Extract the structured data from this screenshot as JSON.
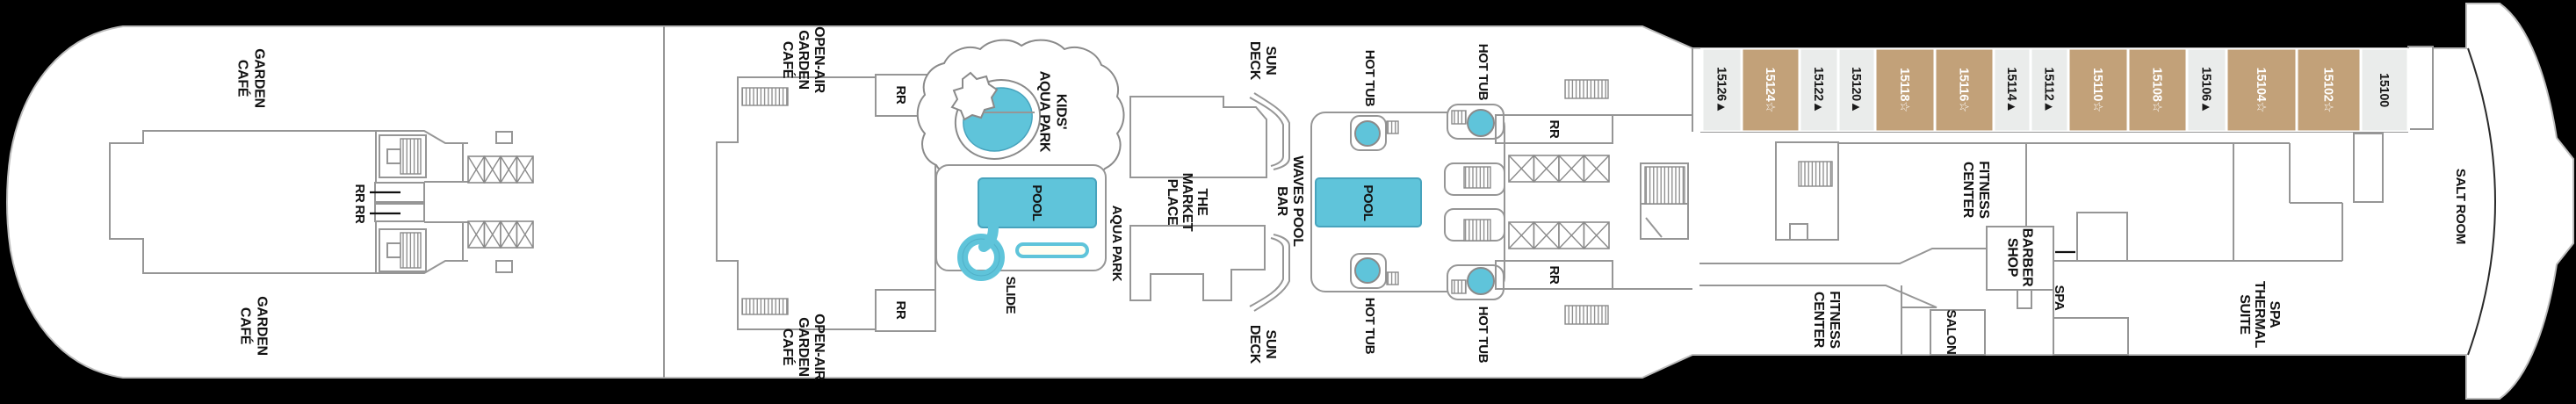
{
  "plan_title": "Cruise ship deck plan - pool and spa deck",
  "colors": {
    "background": "#000000",
    "hull": "#ffffff",
    "wall_line": "#969696",
    "pool_blue": "#5fc4da",
    "pool_blue_stroke": "#47a3bd",
    "cabin_tan": "#c2a179",
    "cabin_light": "#eaeceb",
    "cabin_text_on_tan": "#ffffff",
    "cabin_text_on_light": "#1a1a1a",
    "label_text": "#121212"
  },
  "labels": {
    "garden_cafe_top": {
      "lines": [
        "GARDEN",
        "CAFÉ"
      ]
    },
    "garden_cafe_bottom": {
      "lines": [
        "GARDEN",
        "CAFÉ"
      ]
    },
    "rr_fwd_a": {
      "lines": [
        "RR"
      ]
    },
    "rr_fwd_b": {
      "lines": [
        "RR"
      ]
    },
    "open_air_top": {
      "lines": [
        "OPEN-AIR",
        "GARDEN",
        "CAFÉ"
      ]
    },
    "open_air_bottom": {
      "lines": [
        "OPEN-AIR",
        "GARDEN",
        "CAFÉ"
      ]
    },
    "rr_openair_top": {
      "lines": [
        "RR"
      ]
    },
    "rr_openair_bottom": {
      "lines": [
        "RR"
      ]
    },
    "kids_aqua_park": {
      "lines": [
        "KIDS'",
        "AQUA PARK"
      ]
    },
    "pool_aqua": {
      "lines": [
        "POOL"
      ]
    },
    "slide": {
      "lines": [
        "SLIDE"
      ]
    },
    "aqua_park": {
      "lines": [
        "AQUA PARK"
      ]
    },
    "market_place": {
      "lines": [
        "THE",
        "MARKET",
        "PLACE"
      ]
    },
    "sun_deck_top": {
      "lines": [
        "SUN",
        "DECK"
      ]
    },
    "sun_deck_bottom": {
      "lines": [
        "SUN",
        "DECK"
      ]
    },
    "waves_pool_bar": {
      "lines": [
        "WAVES POOL",
        "BAR"
      ]
    },
    "pool_main": {
      "lines": [
        "POOL"
      ]
    },
    "hot_tub_top_center": {
      "lines": [
        "HOT TUB"
      ]
    },
    "hot_tub_top_right": {
      "lines": [
        "HOT TUB"
      ]
    },
    "hot_tub_bottom_center": {
      "lines": [
        "HOT TUB"
      ]
    },
    "hot_tub_bottom_right": {
      "lines": [
        "HOT TUB"
      ]
    },
    "rr_mid_top": {
      "lines": [
        "RR"
      ]
    },
    "rr_mid_bottom": {
      "lines": [
        "RR"
      ]
    },
    "fitness_center_upper": {
      "lines": [
        "FITNESS",
        "CENTER"
      ]
    },
    "fitness_center_lower": {
      "lines": [
        "FITNESS",
        "CENTER"
      ]
    },
    "barber_shop": {
      "lines": [
        "BARBER",
        "SHOP"
      ]
    },
    "salon": {
      "lines": [
        "SALON"
      ]
    },
    "spa": {
      "lines": [
        "SPA"
      ]
    },
    "spa_thermal_suite": {
      "lines": [
        "SPA",
        "THERMAL",
        "SUITE"
      ]
    },
    "salt_room": {
      "lines": [
        "SALT ROOM"
      ]
    }
  },
  "cabins": [
    {
      "number": "15126",
      "symbol": "▲",
      "color": "light"
    },
    {
      "number": "15124",
      "symbol": "☆",
      "color": "tan"
    },
    {
      "number": "15122",
      "symbol": "▲",
      "color": "light"
    },
    {
      "number": "15120",
      "symbol": "▲",
      "color": "light"
    },
    {
      "number": "15118",
      "symbol": "☆",
      "color": "tan"
    },
    {
      "number": "15116",
      "symbol": "☆",
      "color": "tan"
    },
    {
      "number": "15114",
      "symbol": "▲",
      "color": "light"
    },
    {
      "number": "15112",
      "symbol": "▲",
      "color": "light"
    },
    {
      "number": "15110",
      "symbol": "☆",
      "color": "tan"
    },
    {
      "number": "15108",
      "symbol": "☆",
      "color": "tan"
    },
    {
      "number": "15106",
      "symbol": "▲",
      "color": "light"
    },
    {
      "number": "15104",
      "symbol": "☆",
      "color": "tan"
    },
    {
      "number": "15102",
      "symbol": "☆",
      "color": "tan"
    },
    {
      "number": "15100",
      "symbol": "",
      "color": "light"
    }
  ]
}
